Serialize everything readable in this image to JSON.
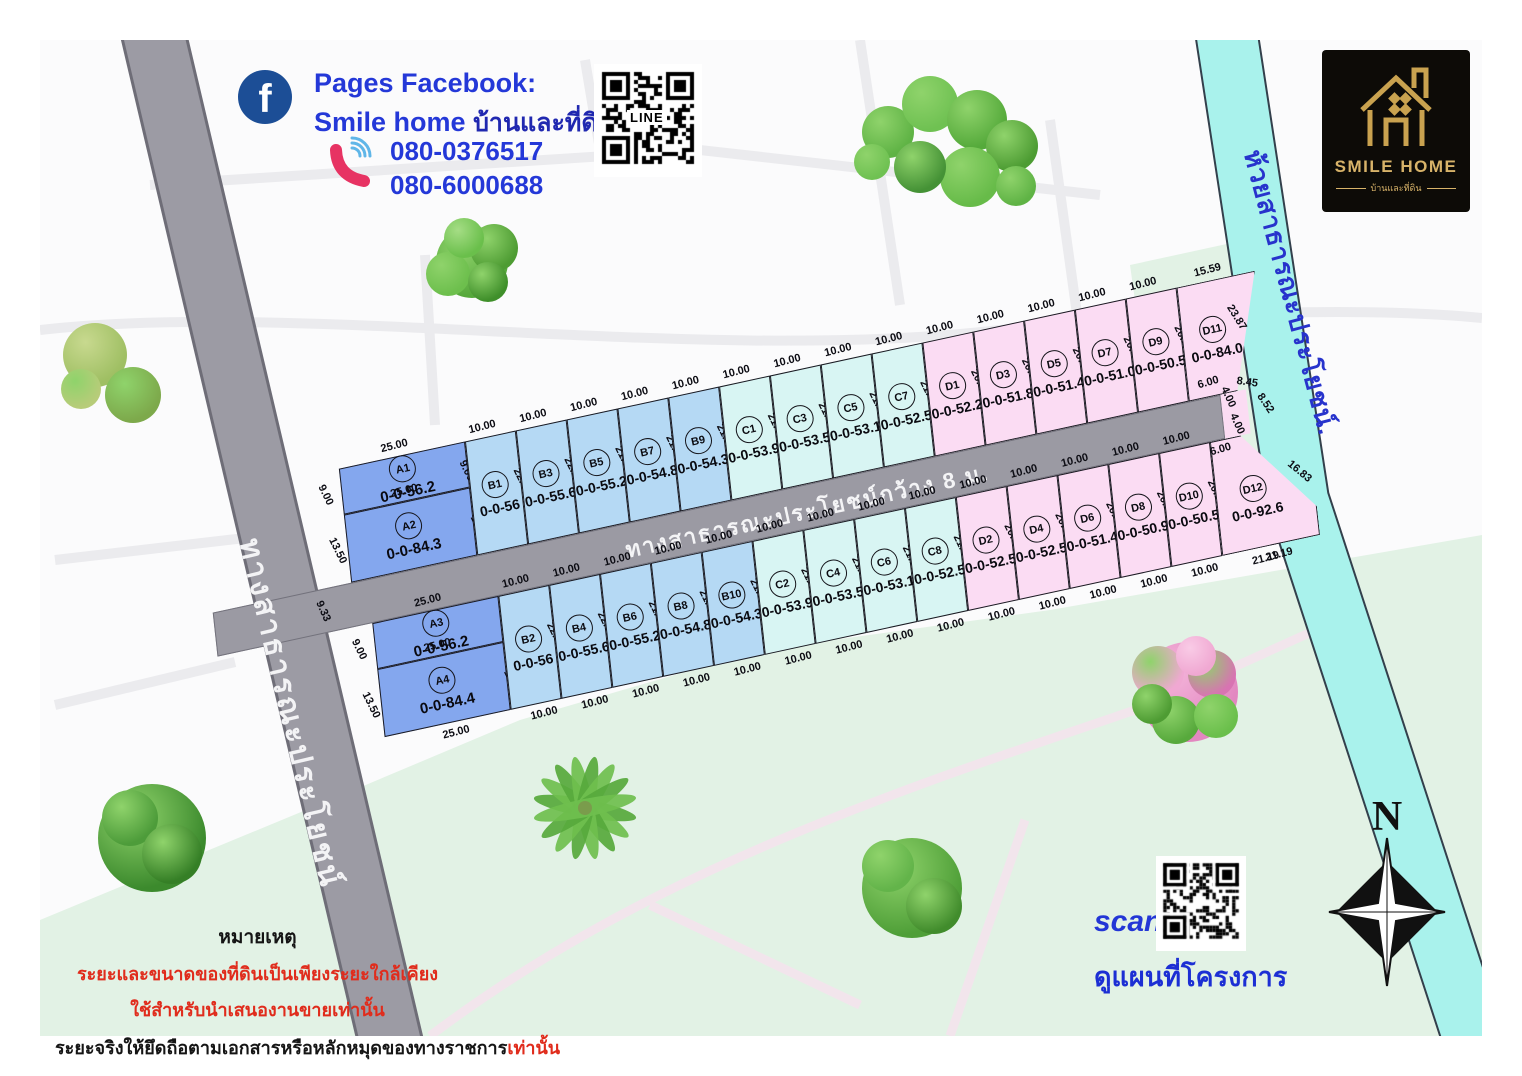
{
  "header": {
    "facebook_label": "Pages Facebook:",
    "page_name_en": "Smile home",
    "page_name_th": "บ้านและที่ดิน",
    "phone1": "080-0376517",
    "phone2": "080-6000688",
    "line_label": "LINE"
  },
  "logo": {
    "title": "SMILE HOME",
    "subtitle": "บ้านและที่ดิน"
  },
  "map": {
    "left_road_label": "ทางสาธารณะประโยชน์",
    "main_road_label": "ทางสาธารณะประโยชน์กว้าง 8 ม.",
    "canal_label": "ห้วยสาธารณะประโยชน์.",
    "road_gap_dim": "9.33",
    "colors": {
      "plot_a": "#84a7ee",
      "plot_b": "#b5d9f4",
      "plot_c": "#d8f5f3",
      "plot_d": "#fbdcf3",
      "road": "#9b9aa3",
      "canal": "#a9f2ec"
    },
    "upper_row": {
      "a_plots": [
        {
          "id": "A1",
          "area": "0-0-56.2",
          "top": "25.00",
          "left": "9.00",
          "right": "9.00"
        },
        {
          "id": "A2",
          "area": "0-0-84.3",
          "top": "25.00",
          "left": "13.50",
          "right": "12.76",
          "bottom": "25.00"
        }
      ],
      "plots": [
        {
          "id": "B1",
          "area": "0-0-56",
          "top": "10.00",
          "side": "22.33",
          "bottom": "10.00",
          "g": "b"
        },
        {
          "id": "B3",
          "area": "0-0-55.6",
          "top": "10.00",
          "side": "22.16",
          "bottom": "10.00",
          "g": "b"
        },
        {
          "id": "B5",
          "area": "0-0-55.2",
          "top": "10.00",
          "side": "21.99",
          "bottom": "10.00",
          "g": "b"
        },
        {
          "id": "B7",
          "area": "0-0-54.8",
          "top": "10.00",
          "side": "21.82",
          "bottom": "10.00",
          "g": "b"
        },
        {
          "id": "B9",
          "area": "0-0-54.3",
          "top": "10.00",
          "side": "21.65",
          "bottom": "10.00",
          "g": "b"
        },
        {
          "id": "C1",
          "area": "0-0-53.9",
          "top": "10.00",
          "side": "21.48",
          "bottom": "10.00",
          "g": "c"
        },
        {
          "id": "C3",
          "area": "0-0-53.5",
          "top": "10.00",
          "side": "21.31",
          "bottom": "10.00",
          "g": "c"
        },
        {
          "id": "C5",
          "area": "0-0-53.1",
          "top": "10.00",
          "side": "21.14",
          "bottom": "10.00",
          "g": "c"
        },
        {
          "id": "C7",
          "area": "0-0-52.5",
          "top": "10.00",
          "side": "21.00",
          "bottom": "10.00",
          "g": "c"
        },
        {
          "id": "D1",
          "area": "0-0-52.2",
          "top": "10.00",
          "side": "20.80",
          "bottom": "10.00",
          "g": "d"
        },
        {
          "id": "D3",
          "area": "0-0-51.8",
          "top": "10.00",
          "side": "20.63",
          "bottom": "10.00",
          "g": "d"
        },
        {
          "id": "D5",
          "area": "0-0-51.4",
          "top": "10.00",
          "side": "20.47",
          "bottom": "10.00",
          "g": "d"
        },
        {
          "id": "D7",
          "area": "0-0-51.0",
          "top": "10.00",
          "side": "20.30",
          "bottom": "10.00",
          "g": "d"
        },
        {
          "id": "D9",
          "area": "0-0-50.5",
          "top": "10.00",
          "side": "20.13",
          "bottom": "10.00",
          "g": "d"
        },
        {
          "id": "D11",
          "area": "0-0-84.0",
          "top": "15.59",
          "side": "23.87",
          "bottom": "",
          "g": "d"
        }
      ]
    },
    "lower_row": {
      "a_plots": [
        {
          "id": "A3",
          "area": "0-0-56.2",
          "top": "25.00",
          "left": "9.00"
        },
        {
          "id": "A4",
          "area": "0-0-84.4",
          "top": "25.00",
          "left": "13.50",
          "right": "13.50",
          "bottom": "25.00"
        }
      ],
      "plots": [
        {
          "id": "B2",
          "area": "0-0-56",
          "top": "10.00",
          "side": "22.33",
          "bottom": "10.00",
          "g": "b"
        },
        {
          "id": "B4",
          "area": "0-0-55.6",
          "top": "10.00",
          "side": "22.16",
          "bottom": "10.00",
          "g": "b"
        },
        {
          "id": "B6",
          "area": "0-0-55.2",
          "top": "10.00",
          "side": "21.99",
          "bottom": "10.00",
          "g": "b"
        },
        {
          "id": "B8",
          "area": "0-0-54.8",
          "top": "10.00",
          "side": "21.82",
          "bottom": "10.00",
          "g": "b"
        },
        {
          "id": "B10",
          "area": "0-0-54.3",
          "top": "10.00",
          "side": "21.65",
          "bottom": "10.00",
          "g": "b"
        },
        {
          "id": "C2",
          "area": "0-0-53.9",
          "top": "10.00",
          "side": "21.48",
          "bottom": "10.00",
          "g": "c"
        },
        {
          "id": "C4",
          "area": "0-0-53.5",
          "top": "10.00",
          "side": "21.31",
          "bottom": "10.00",
          "g": "c"
        },
        {
          "id": "C6",
          "area": "0-0-53.1",
          "top": "10.00",
          "side": "21.14",
          "bottom": "10.00",
          "g": "c"
        },
        {
          "id": "C8",
          "area": "0-0-52.5",
          "top": "10.00",
          "side": "21.00",
          "bottom": "10.00",
          "g": "c"
        },
        {
          "id": "D2",
          "area": "0-0-52.5",
          "top": "10.00",
          "side": "20.80",
          "bottom": "10.00",
          "g": "d"
        },
        {
          "id": "D4",
          "area": "0-0-52.5",
          "top": "10.00",
          "side": "20.63",
          "bottom": "10.00",
          "g": "d"
        },
        {
          "id": "D6",
          "area": "0-0-51.4",
          "top": "10.00",
          "side": "20.46",
          "bottom": "10.00",
          "g": "d"
        },
        {
          "id": "D8",
          "area": "0-0-50.9",
          "top": "10.00",
          "side": "20.29",
          "bottom": "10.00",
          "g": "d"
        },
        {
          "id": "D10",
          "area": "0-0-50.5",
          "top": "10.00",
          "side": "20.12",
          "bottom": "10.00",
          "g": "d"
        },
        {
          "id": "D12",
          "area": "0-0-92.6",
          "top": "6.00",
          "side": "",
          "bottom": "21.19",
          "g": "d"
        }
      ]
    },
    "road_end_dims": {
      "d11_bottom": "6.00",
      "right_top": "4.00",
      "right_mid": "8.45",
      "right_bottom": "4.00",
      "d12_top": "6.00",
      "d12_left": "8.52",
      "d12_canal": "16.83",
      "d12_bottom": "21.19",
      "d11_side": "23.87"
    }
  },
  "notes": {
    "heading": "หมายเหตุ",
    "line1": "ระยะและขนาดของที่ดินเป็นเพียงระยะใกล้เคียง",
    "line2": "ใช้สำหรับนำเสนองานขายเท่านั้น",
    "line3_black": "ระยะจริงให้ยึดถือตามเอกสารหรือหลักหมุดของทางราชการ",
    "line3_red": "เท่านั้น"
  },
  "footer": {
    "scan_label": "scan",
    "map_link_label": "ดูแผนที่โครงการ"
  },
  "compass": {
    "north_label": "N"
  }
}
